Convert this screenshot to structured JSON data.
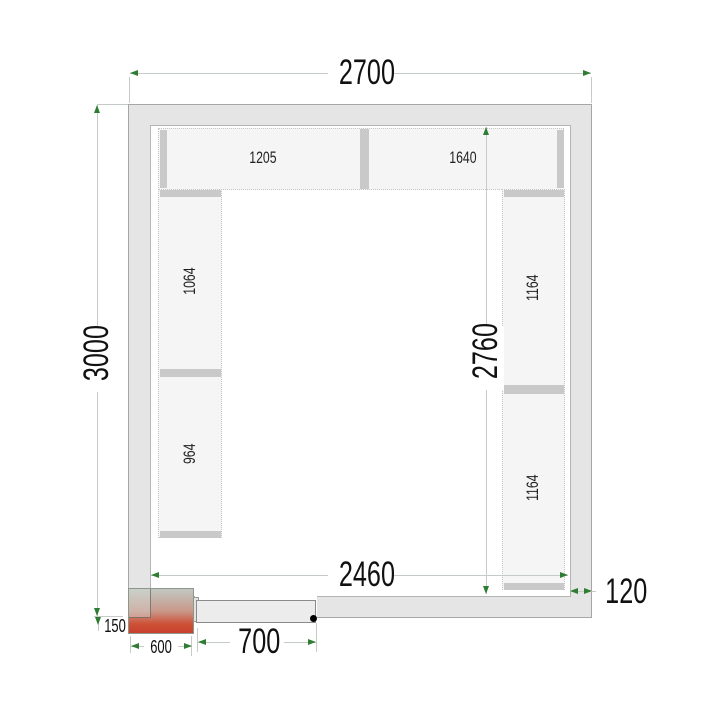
{
  "drawing_type": "cold-room floor plan with shelving",
  "dims": {
    "outer_width": "2700",
    "outer_height": "3000",
    "inner_height": "2760",
    "inner_width": "2460",
    "door_width": "700",
    "wall_thickness": "120",
    "unit_width": "600",
    "unit_offset": "150"
  },
  "shelves": {
    "top_left": "1205",
    "top_right": "1640",
    "left_upper": "1064",
    "left_lower": "964",
    "right_upper": "1164",
    "right_lower": "1164"
  },
  "colors": {
    "wall_fill": "#e5e5e5",
    "wall_border": "#a6a6a6",
    "shelf_fill": "#f5f5f5",
    "shelf_dotted_border": "#c6c6c6",
    "shelf_post": "#c9c9c9",
    "dimension_line": "#c5cbc5",
    "arrow_green": "#2e7d32",
    "monoblock_gradient_top": "#c1c8c1",
    "monoblock_gradient_bottom": "#c93f2c",
    "hinge_dot": "#000000",
    "text": "#111111"
  },
  "icons": {
    "dim_arrow": "green triangle arrowhead",
    "door_hinge": "filled black circle"
  }
}
